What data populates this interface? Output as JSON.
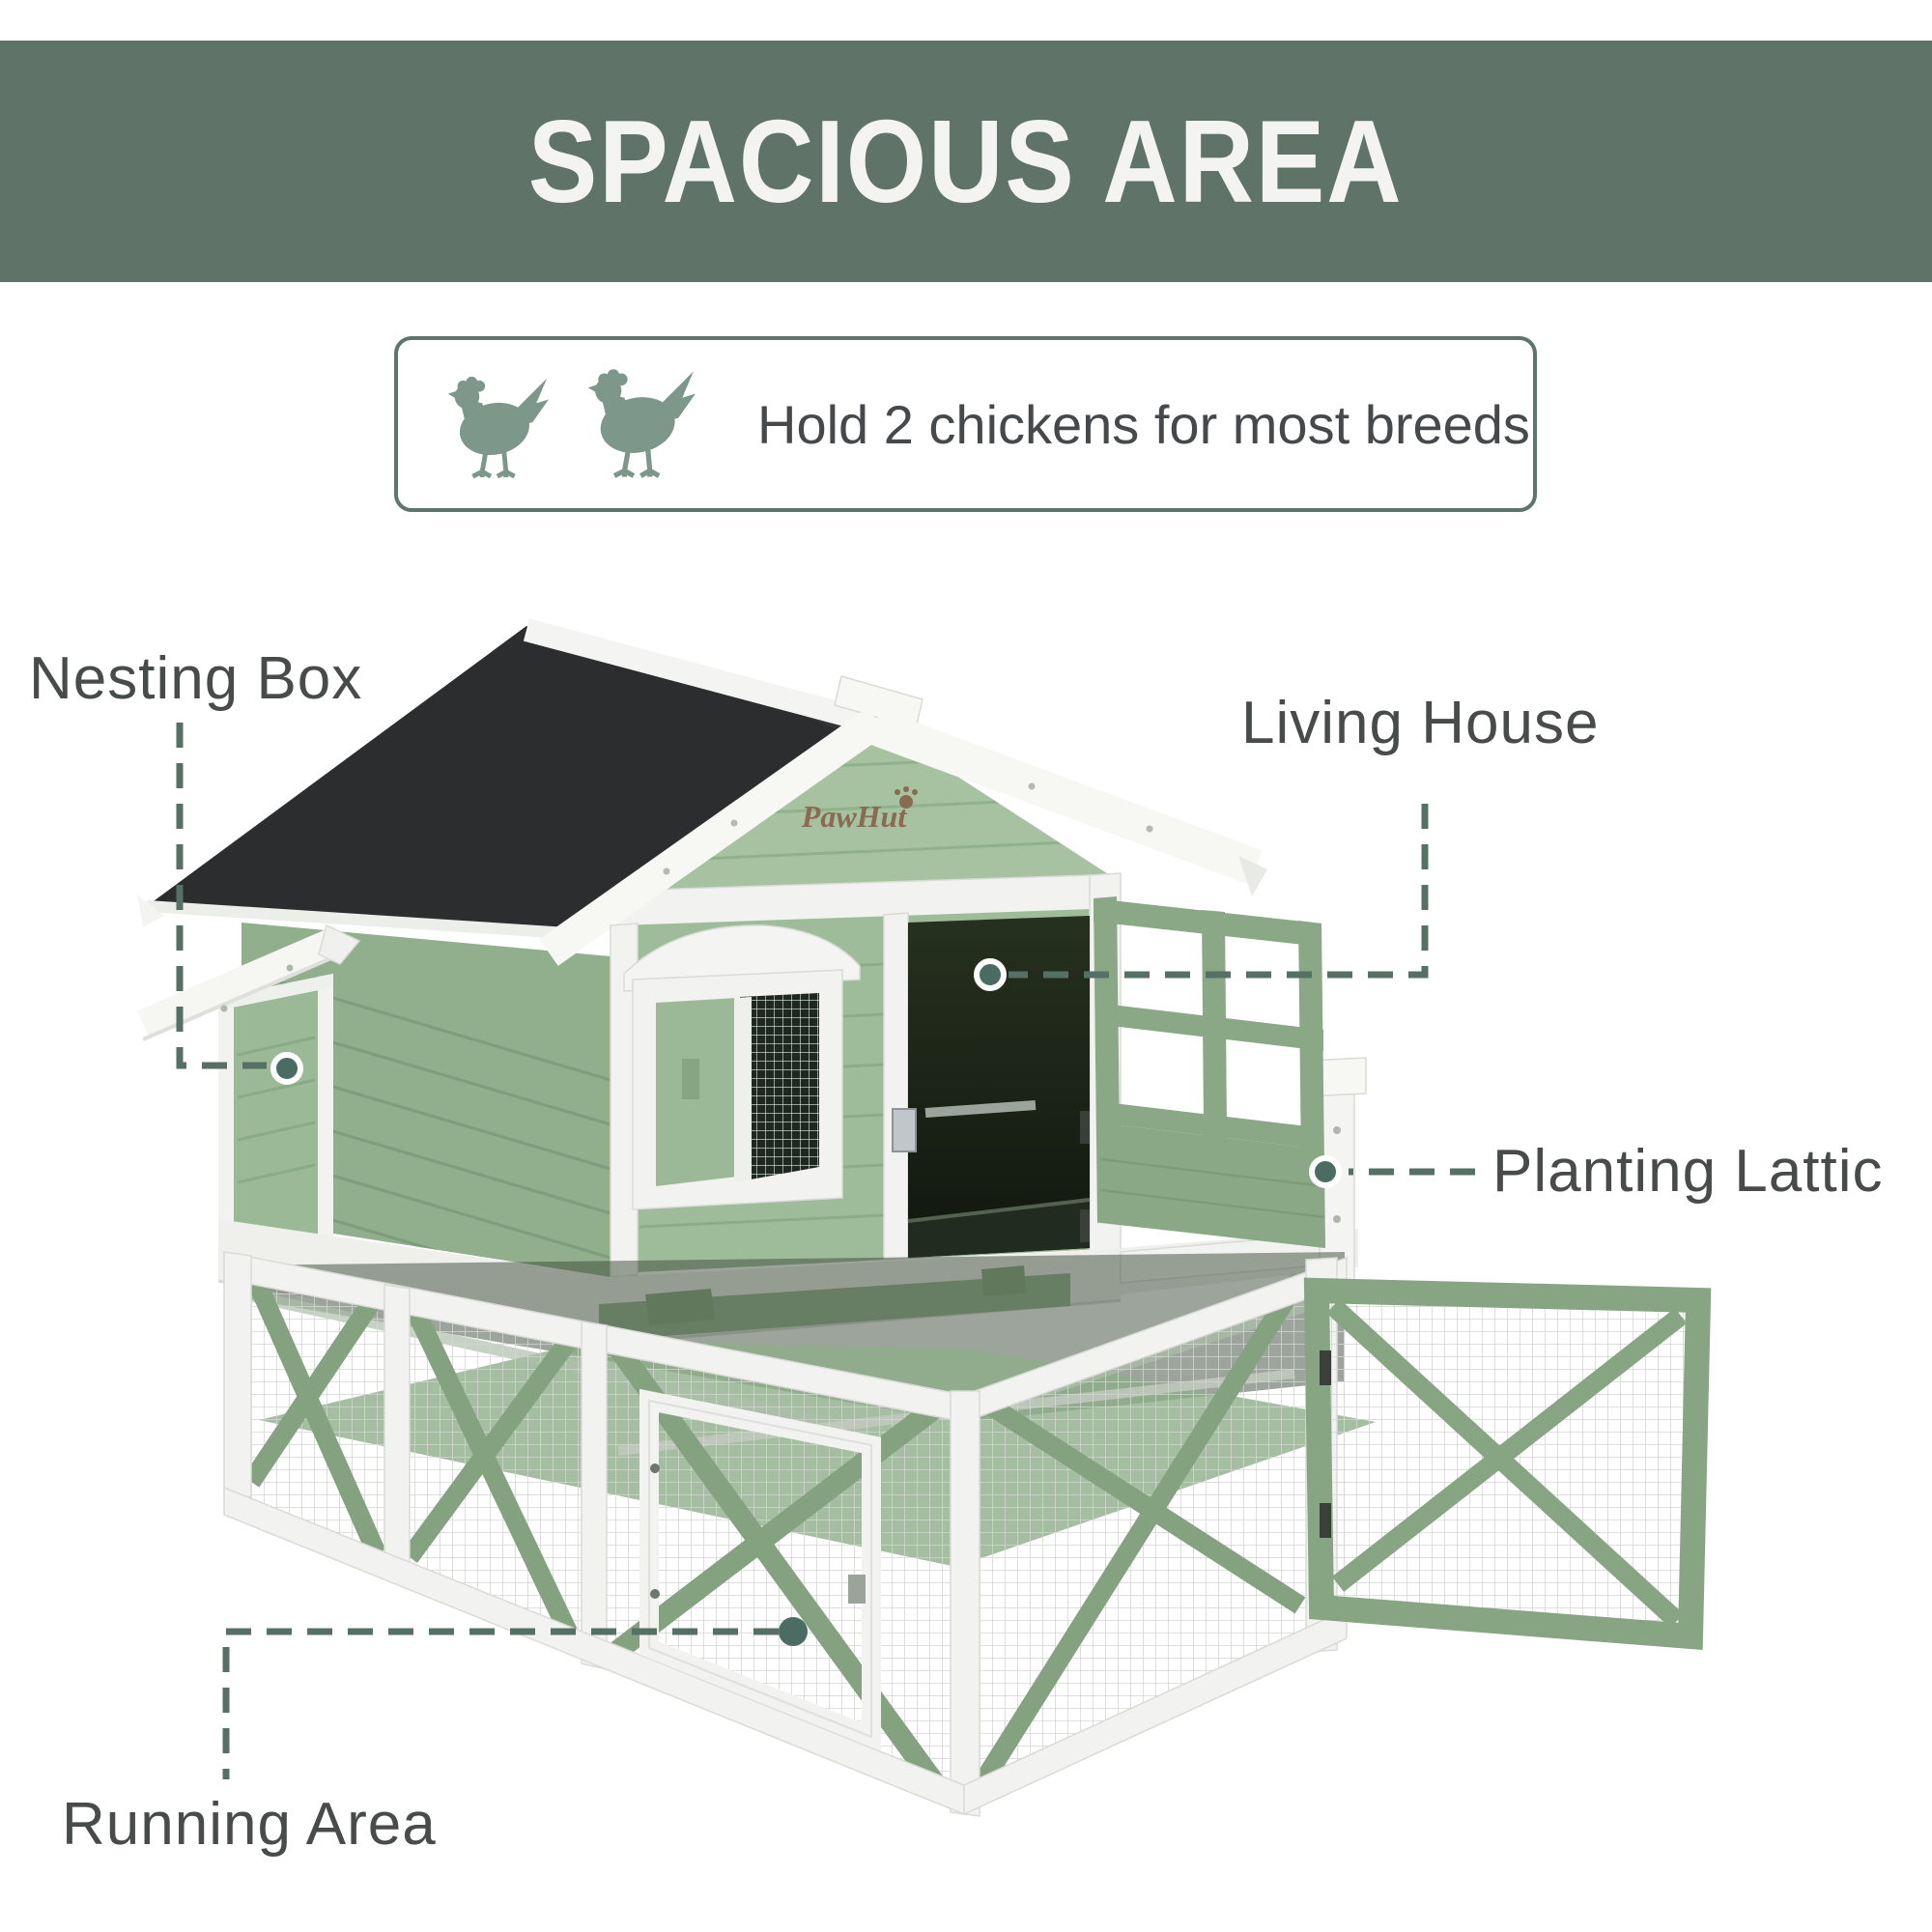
{
  "banner": {
    "title": "SPACIOUS AREA"
  },
  "badge": {
    "text": "Hold 2 chickens for most breeds",
    "chicken_count": 2
  },
  "coop": {
    "logo": "PawHut"
  },
  "callouts": {
    "nesting_box": {
      "label": "Nesting Box"
    },
    "living_house": {
      "label": "Living House"
    },
    "planting_lattice": {
      "label": "Planting Lattic"
    },
    "running_area": {
      "label": "Running Area"
    }
  },
  "colors": {
    "banner_bg": "#5f7369",
    "accent_sage": "#567065",
    "dot_fill": "#4a6c62",
    "house_green": "#9fbc9a",
    "roof_black": "#2b2d2e",
    "trim_white": "#f2f3f0",
    "label_text": "#474b49",
    "chicken_icon": "#7e978b"
  }
}
